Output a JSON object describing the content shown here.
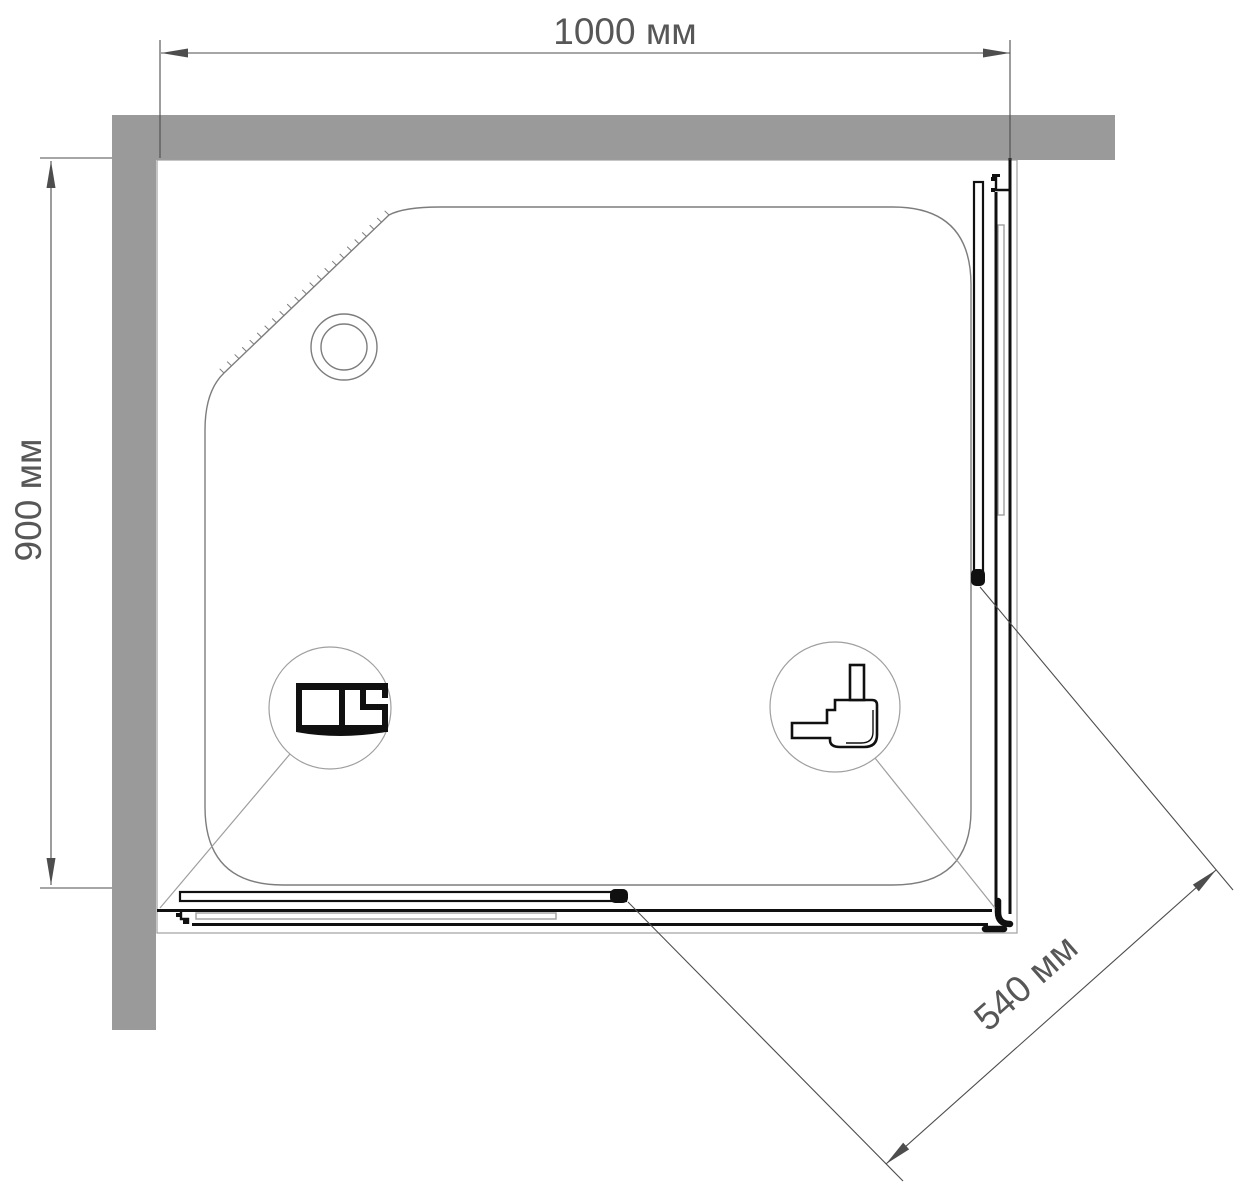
{
  "drawing": {
    "dim_width": {
      "label": "1000 мм"
    },
    "dim_depth": {
      "label": "900 мм"
    },
    "dim_door": {
      "label": "540 мм"
    }
  },
  "colors": {
    "wall": "#9a9a9a",
    "outline": "#7d7d7d",
    "light": "#9f9f9f",
    "profile": "#101010",
    "dimension": "#4d4d4d",
    "text": "#575757",
    "background": "#ffffff"
  }
}
